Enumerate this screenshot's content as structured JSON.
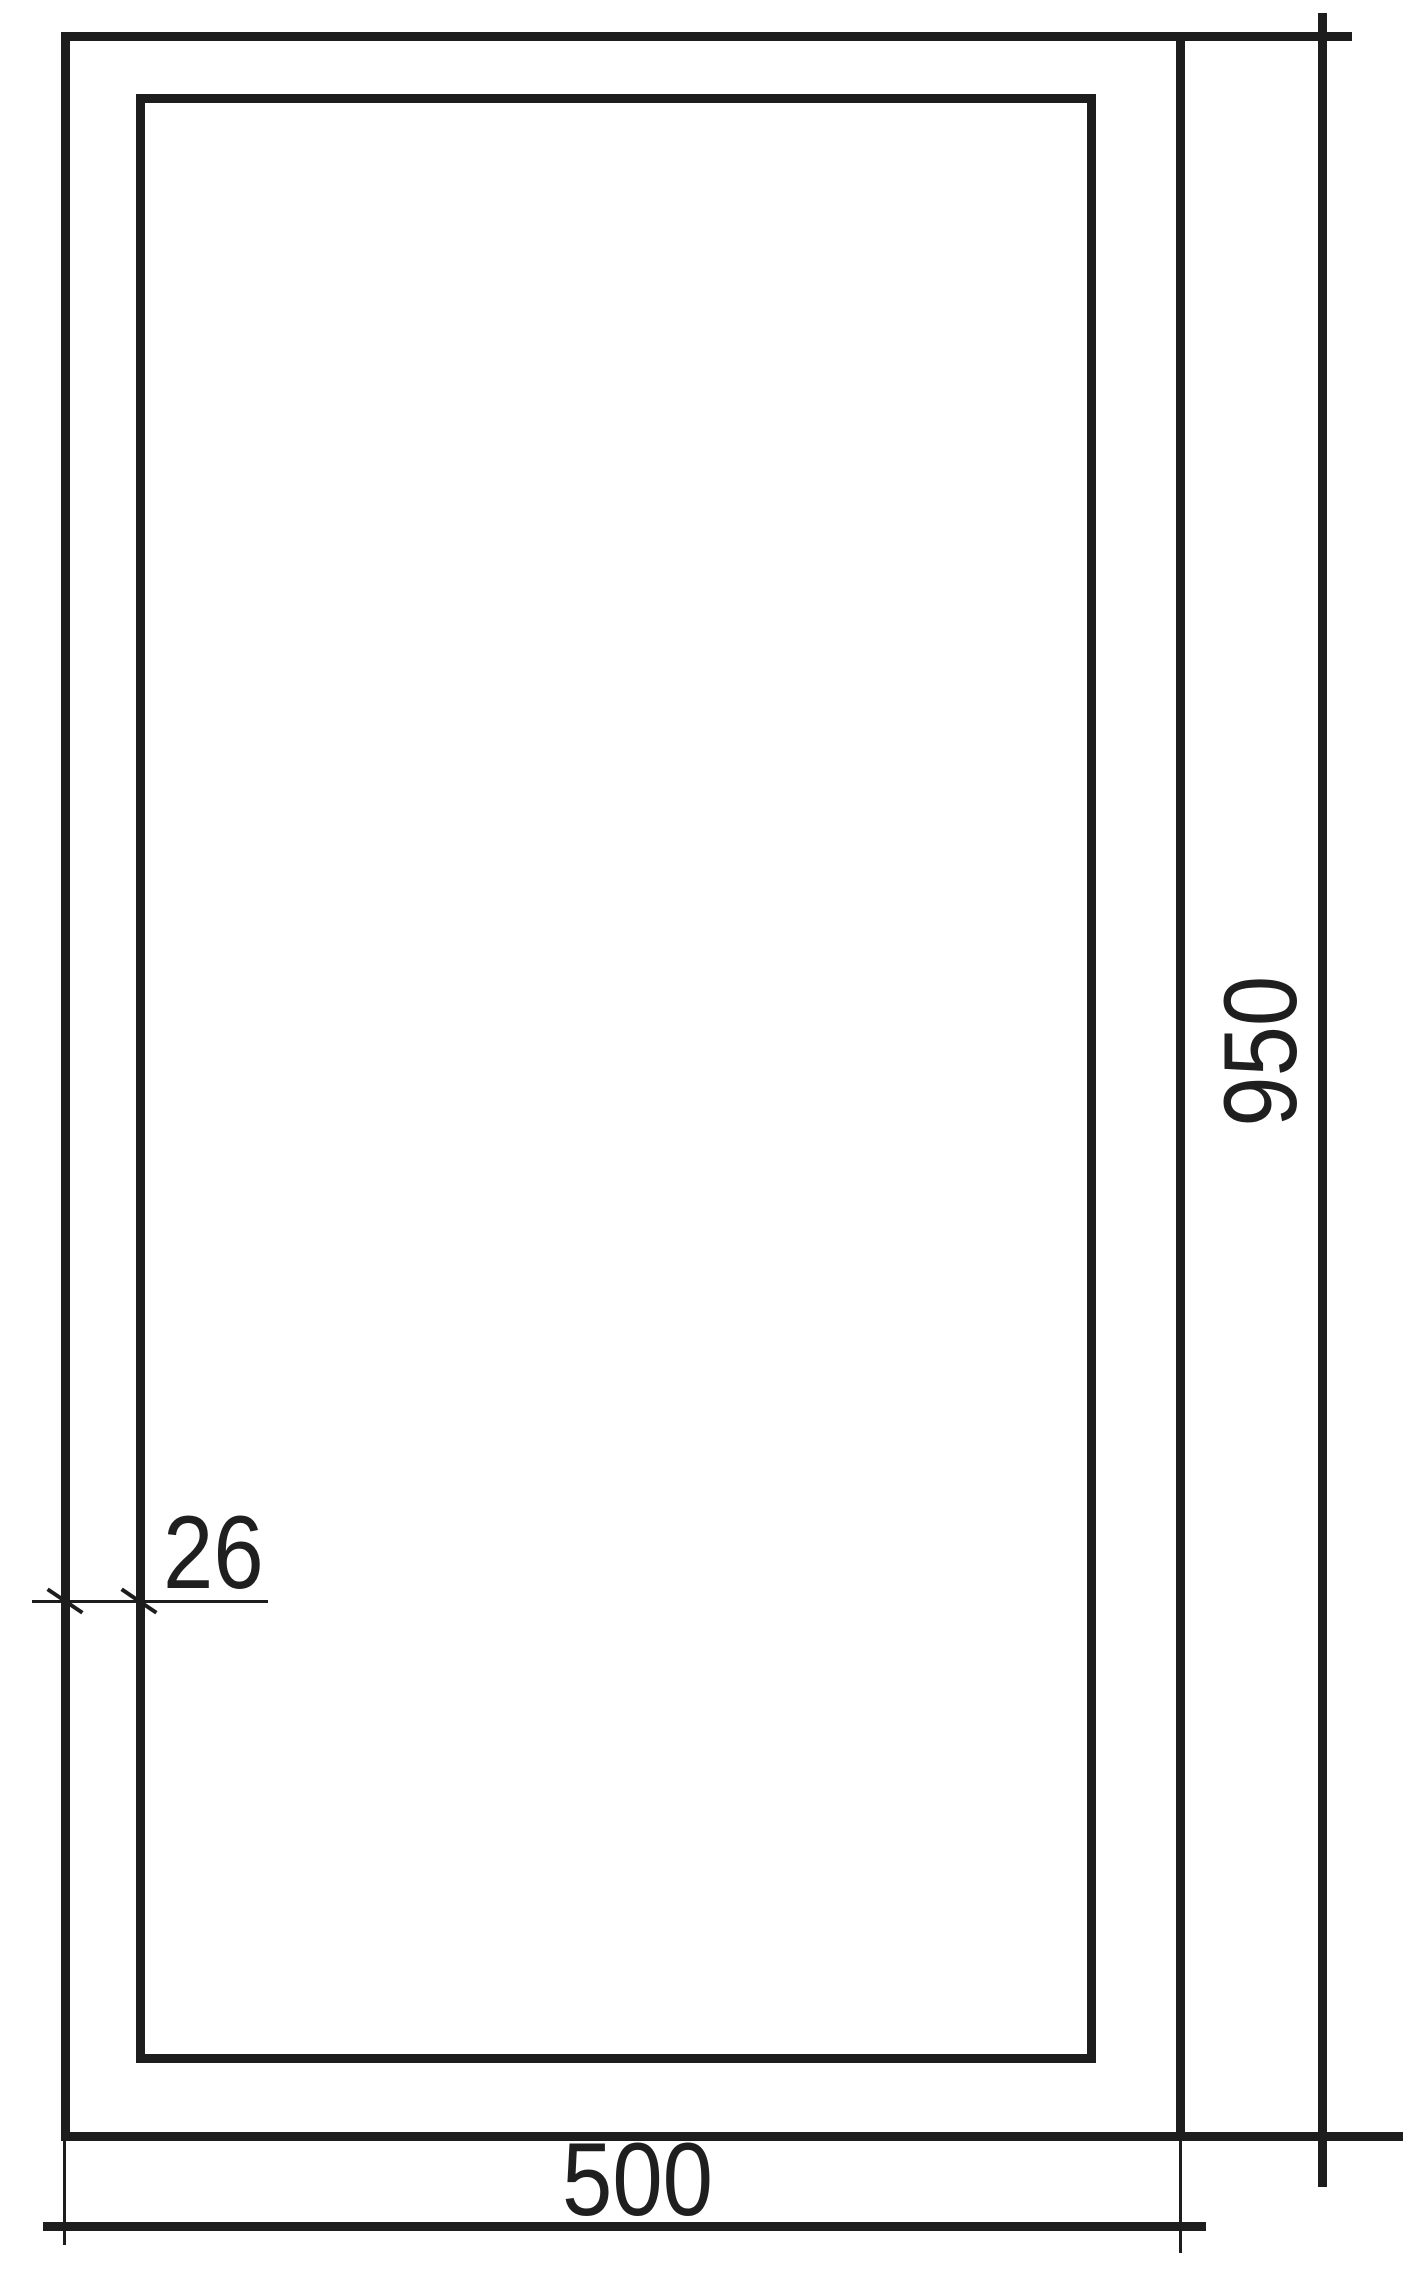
{
  "drawing": {
    "kind": "technical-dimension-drawing",
    "labels": {
      "height": "950",
      "width": "500",
      "thickness": "26"
    },
    "colors": {
      "line": "#1d1d1d",
      "text": "#1f1f1f",
      "background": "#ffffff"
    }
  }
}
